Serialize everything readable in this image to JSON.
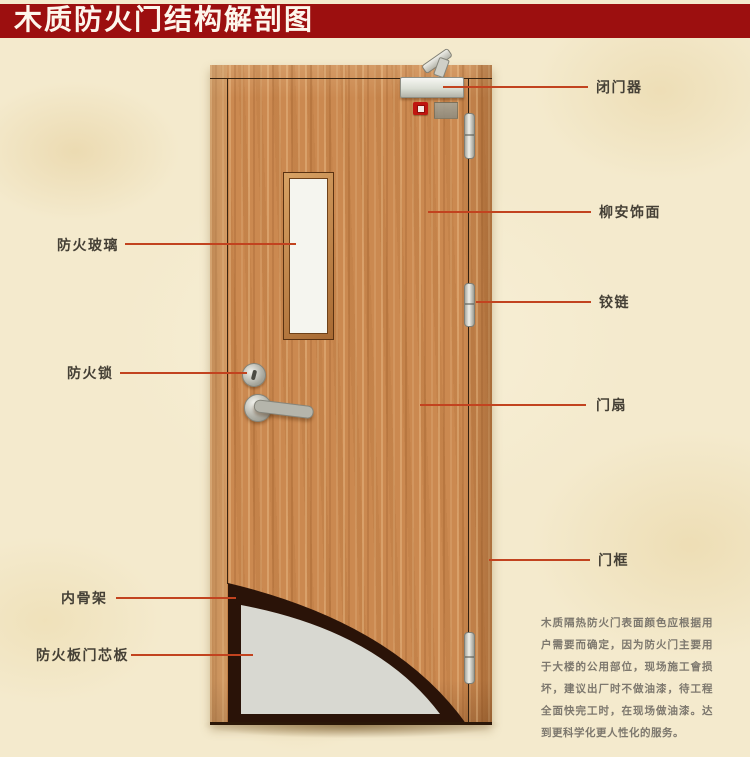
{
  "title": "木质防火门结构解剖图",
  "labels": {
    "left": [
      {
        "id": "fire-glass",
        "text": "防火玻璃"
      },
      {
        "id": "fire-lock",
        "text": "防火锁"
      },
      {
        "id": "inner-skeleton",
        "text": "内骨架"
      },
      {
        "id": "fire-board-core",
        "text": "防火板门芯板"
      }
    ],
    "right": [
      {
        "id": "door-closer",
        "text": "闭门器"
      },
      {
        "id": "lauan-veneer",
        "text": "柳安饰面"
      },
      {
        "id": "hinge",
        "text": "铰链"
      },
      {
        "id": "door-leaf",
        "text": "门扇"
      },
      {
        "id": "door-frame",
        "text": "门框"
      }
    ]
  },
  "description": "木质隔热防火门表面颜色应根据用户需要而确定，因为防火门主要用于大楼的公用部位，现场施工會损坏，建议出厂时不做油漆，待工程全面快完工时，在现场做油漆。达到更科学化更人性化的服务。",
  "colors": {
    "banner": "#9c0f0f",
    "background": "#f4eacd",
    "wood": "#cb8950",
    "leader_line": "#c2431f",
    "label_text": "#454036",
    "description_text": "#7d786e",
    "core_gray": "#d8d8d1",
    "skeleton_dark": "#2a1308"
  }
}
